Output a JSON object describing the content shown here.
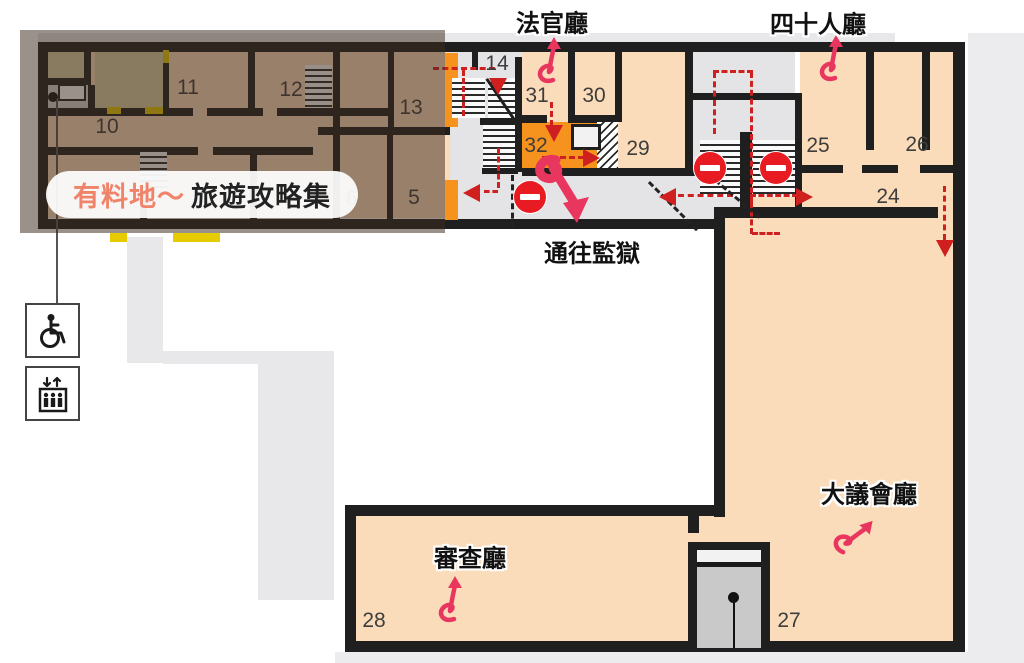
{
  "map": {
    "watermark": {
      "brand": "有料地～",
      "title": "旅遊攻略集"
    },
    "halls": {
      "judges": "法官廳",
      "forty": "四十人廳",
      "prison": "通往監獄",
      "scrutiny": "審查廳",
      "council": "大議會廳"
    },
    "rooms": {
      "5": "5",
      "6": "6",
      "10": "10",
      "11": "11",
      "12": "12",
      "13": "13",
      "14": "14",
      "24": "24",
      "25": "25",
      "26": "26",
      "27": "27",
      "28": "28",
      "29": "29",
      "30": "30",
      "31": "31",
      "32": "32"
    },
    "icons": [
      "wheelchair-icon",
      "elevator-icon",
      "no-entry-icon",
      "route-arrow-icon",
      "curl-arrow-icon"
    ],
    "colors": {
      "floor_peach": "#fbdcba",
      "highlight_room_orange": "#f6921e",
      "corridor_gray": "#e4e4e6",
      "wall_black": "#1f1f1f",
      "route_red": "#cf1f1f",
      "marker_pink": "#e8365e",
      "door_yellow": "#e5cb00",
      "tan_room": "#d9d2a6",
      "overlay": "rgba(64,45,33,0.52)",
      "watermark_brand": "#f0846a"
    }
  }
}
